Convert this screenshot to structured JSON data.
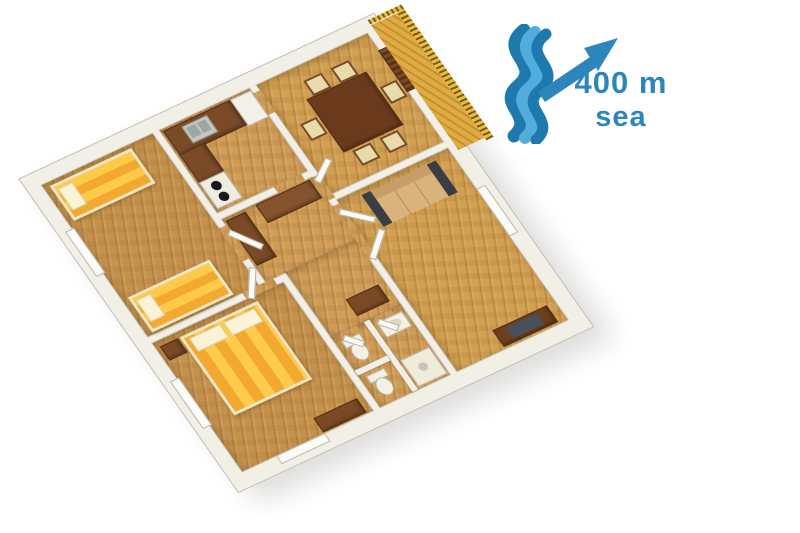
{
  "annotation": {
    "distance": "400 m",
    "place": "sea",
    "text_color": "#2C86BC",
    "icons": [
      {
        "name": "sea-waves-icon",
        "color_dark": "#1E79AE",
        "color_light": "#53ADDC"
      },
      {
        "name": "direction-arrow-icon",
        "direction": "northeast",
        "color": "#2C86BC"
      }
    ]
  },
  "floor_plan": {
    "type": "apartment-3d-top-view",
    "wall_color": "#F1EFE6",
    "floor_wood_color": "#CF9D58",
    "rooms": [
      {
        "name": "bedroom-twin",
        "furniture": [
          "single-bed",
          "single-bed",
          "window"
        ]
      },
      {
        "name": "kitchen",
        "furniture": [
          "kitchen-cabinets",
          "sink",
          "fridge",
          "stove"
        ]
      },
      {
        "name": "dining-room",
        "furniture": [
          "dining-table",
          "chair",
          "chair",
          "chair",
          "chair",
          "chair",
          "chair",
          "entrance-door"
        ]
      },
      {
        "name": "balcony",
        "furniture": [
          "railing"
        ]
      },
      {
        "name": "hallway",
        "furniture": [
          "wardrobe",
          "cabinet",
          "sideboard"
        ]
      },
      {
        "name": "bedroom-double",
        "furniture": [
          "double-bed",
          "nightstand",
          "dresser",
          "window"
        ]
      },
      {
        "name": "living-room",
        "furniture": [
          "sofa",
          "tv-stand",
          "tv",
          "window"
        ]
      },
      {
        "name": "bathroom",
        "furniture": [
          "toilet",
          "toilet",
          "washbasin",
          "shower"
        ]
      }
    ],
    "furniture_colors": {
      "bed_gold": "#F3A92F",
      "bed_stripe": "#FFC94A",
      "pillow": "#FAF3D6",
      "dark_wood": "#7A4A27",
      "sofa_cushion": "#D9B37C",
      "sofa_arm": "#3A3D45",
      "tv_screen": "#49505C",
      "fixture_white": "#F4F0E4",
      "balcony_gold": "#E0AC35"
    }
  }
}
